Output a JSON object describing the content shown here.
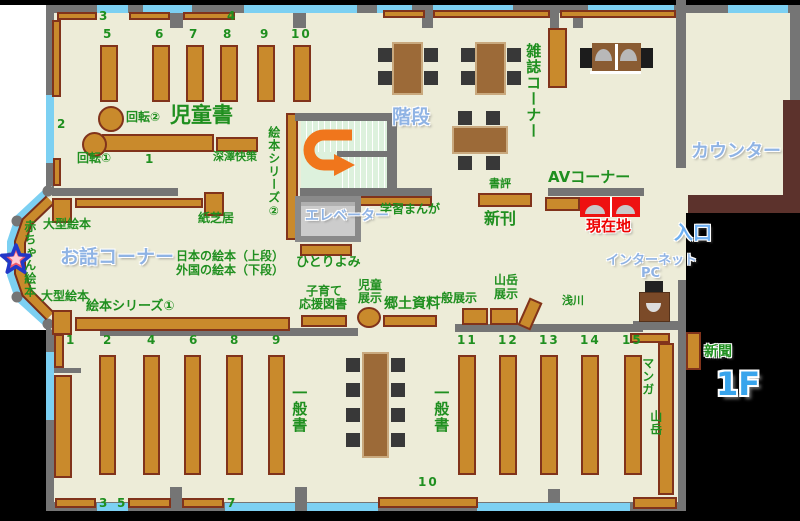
{
  "floor_label": "1F",
  "areas": {
    "kids_books": "児童書",
    "story_corner": "お話コーナー",
    "magazine_corner": "雑誌コーナー",
    "counter": "カウンター",
    "stairs": "階段",
    "elevator": "エレベーター",
    "av_corner": "AVコーナー",
    "entrance": "入口",
    "internet_line1": "インターネット",
    "internet_line2": "PC",
    "current_location": "現在地",
    "general_books": "一般書",
    "newspaper": "新聞",
    "local_materials": "郷土資料"
  },
  "shelf_labels": {
    "rotation2": "回転②",
    "rotation1": "回転①",
    "fukazawa": "深澤快策",
    "picture_book_series2": "絵本シリーズ②",
    "kamishibai": "紙芝居",
    "large_picture_books": "大型絵本",
    "baby_picture_books": "赤ちゃん絵本",
    "japanese_picture_books": "日本の絵本（上段）",
    "foreign_picture_books": "外国の絵本（下段）",
    "hitoriyomi": "ひとりよみ",
    "study_manga": "学習まんが",
    "picture_book_series1": "絵本シリーズ①",
    "parenting_line1": "子育て",
    "parenting_line2": "応援図書",
    "child_exhibit_line1": "児童",
    "child_exhibit_line2": "展示",
    "book_review": "書評",
    "new_books": "新刊",
    "general_exhibit": "一般展示",
    "mountain_exhibit_line1": "山岳",
    "mountain_exhibit_line2": "展示",
    "asakawa": "浅川",
    "manga": "マンガ",
    "mountain": "山岳"
  },
  "nums": {
    "top": [
      "3",
      "4"
    ],
    "kids": [
      "5",
      "6",
      "7",
      "8",
      "9",
      "10"
    ],
    "kids_side": "2",
    "kids_row": "1",
    "bottom_left": [
      "1",
      "2",
      "4",
      "6",
      "8",
      "9"
    ],
    "bottom_right": [
      "11",
      "12",
      "13",
      "14",
      "15"
    ],
    "bottom_edge": [
      "3",
      "5",
      "7"
    ],
    "bottom_center": "10"
  },
  "colors": {
    "floor": "#edecd8",
    "wall": "#757575",
    "window": "#7cd0f2",
    "shelf": "#c98a2c",
    "shelf_border": "#81331b",
    "table": "#9c6a38",
    "chair": "#383838",
    "outside": "#000000",
    "counter_desk": "#5c322c",
    "stairs_fill": "#ddf1dd",
    "arrow": "#f0761c",
    "elevator": "#cccccc",
    "highlight_red": "#ee1111",
    "text_green": "#1f8f1f",
    "text_blue": "#8fb3e4",
    "text_red": "#ee0000"
  }
}
